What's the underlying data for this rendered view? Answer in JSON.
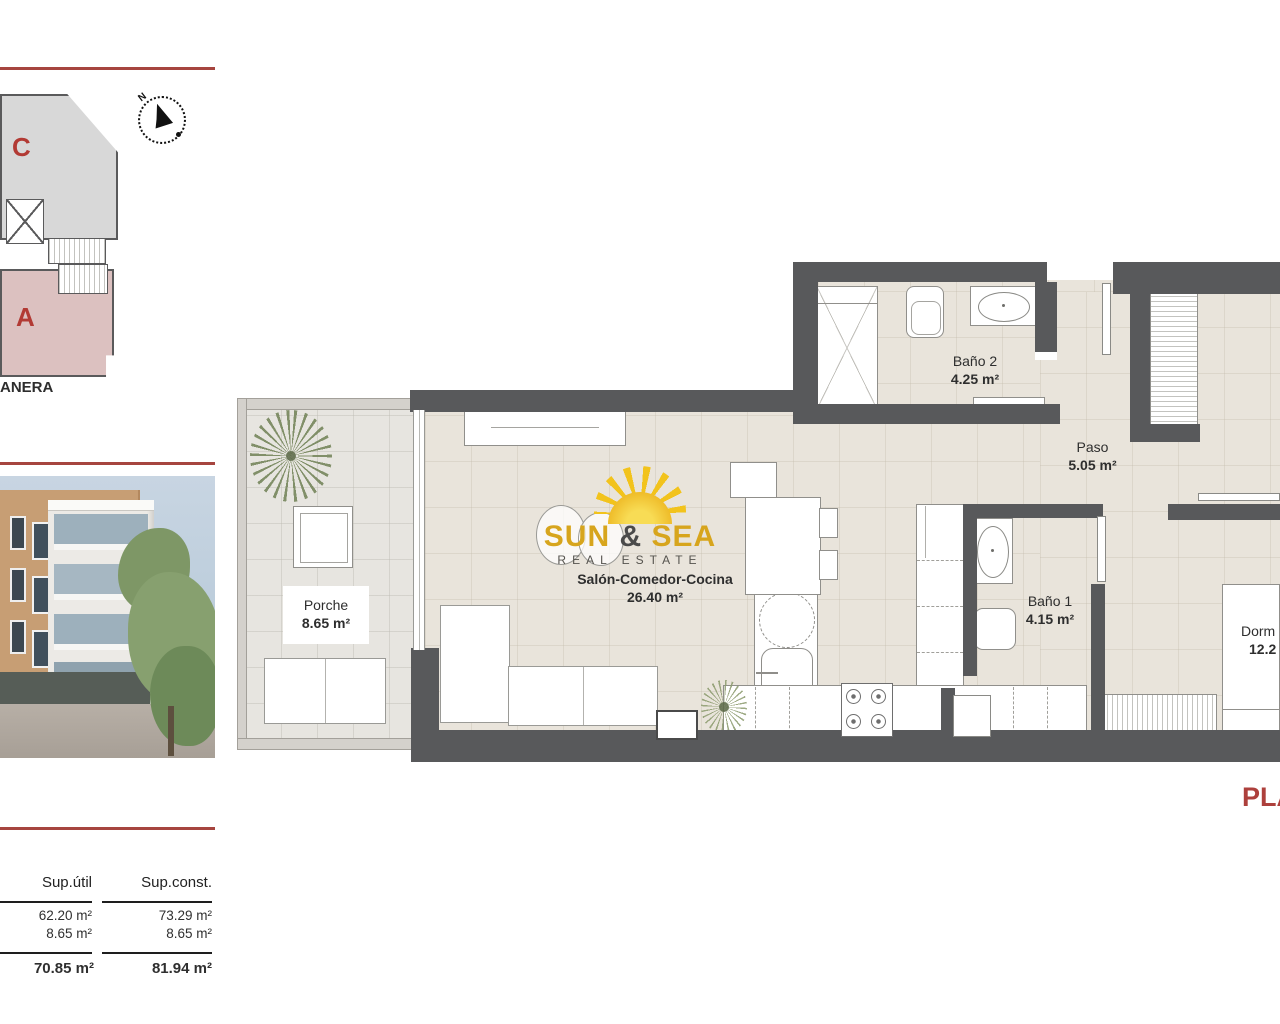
{
  "accent": {
    "line_color": "#a6453f",
    "wall_color": "#58595b"
  },
  "left_panel": {
    "street_label": "ANERA",
    "site_plan": {
      "unit_c": "C",
      "unit_a": "A",
      "compass_north": "N"
    },
    "areas_table": {
      "header_util": "Sup.útil",
      "header_const": "Sup.const.",
      "rows": [
        {
          "util": "62.20 m²",
          "const": "73.29 m²"
        },
        {
          "util": "8.65 m²",
          "const": "8.65 m²"
        }
      ],
      "total_util": "70.85 m²",
      "total_const": "81.94 m²"
    }
  },
  "watermark": {
    "word1": "SUN",
    "amp": "&",
    "word2": "SEA",
    "subtitle": "REAL ESTATE"
  },
  "plan": {
    "rooms": {
      "bano2": {
        "name": "Baño 2",
        "area": "4.25 m²"
      },
      "paso": {
        "name": "Paso",
        "area": "5.05 m²"
      },
      "porche": {
        "name": "Porche",
        "area": "8.65 m²"
      },
      "salon": {
        "name": "Salón-Comedor-Cocina",
        "area": "26.40 m²"
      },
      "bano1": {
        "name": "Baño 1",
        "area": "4.15 m²"
      },
      "dormitorio": {
        "name": "Dorm",
        "area": "12.2"
      }
    },
    "plan_title_partial": "PLA"
  }
}
